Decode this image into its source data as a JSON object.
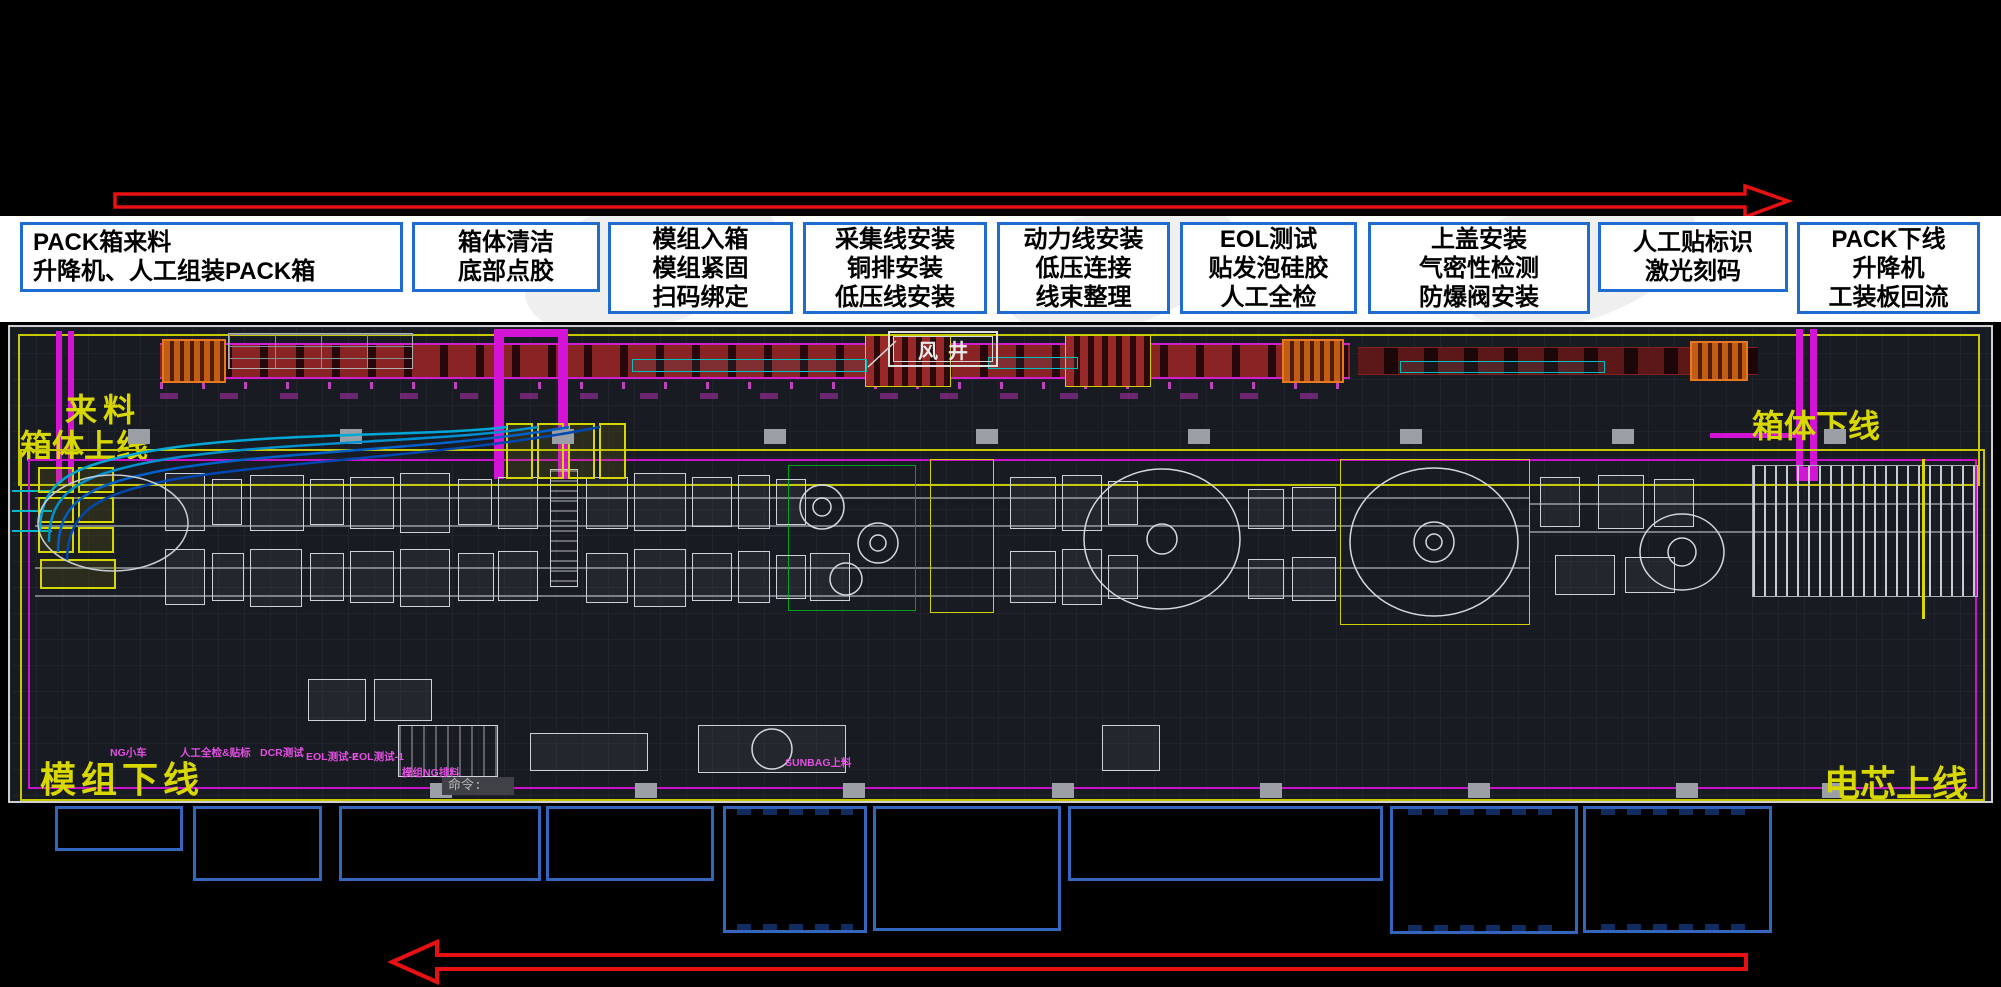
{
  "flow": {
    "top_arrow_direction": "right",
    "bottom_arrow_direction": "left",
    "arrow_color": "#e81111"
  },
  "process_steps": [
    {
      "line1": "PACK箱来料",
      "line2": "升降机、人工组装PACK箱",
      "line3": ""
    },
    {
      "line1": "箱体清洁",
      "line2": "底部点胶",
      "line3": ""
    },
    {
      "line1": "模组入箱",
      "line2": "模组紧固",
      "line3": "扫码绑定"
    },
    {
      "line1": "采集线安装",
      "line2": "铜排安装",
      "line3": "低压线安装"
    },
    {
      "line1": "动力线安装",
      "line2": "低压连接",
      "line3": "线束整理"
    },
    {
      "line1": "EOL测试",
      "line2": "贴发泡硅胶",
      "line3": "人工全检"
    },
    {
      "line1": "上盖安装",
      "line2": "气密性检测",
      "line3": "防爆阀安装"
    },
    {
      "line1": "人工贴标识",
      "line2": "激光刻码",
      "line3": ""
    },
    {
      "line1": "PACK下线",
      "line2": "升降机",
      "line3": "工装板回流"
    }
  ],
  "cad": {
    "labels": {
      "incoming": "来料",
      "box_line_in": "箱体上线",
      "box_line_out": "箱体下线",
      "wind_shaft": "风井",
      "module_offline": "模组下线",
      "cell_online": "电芯上线",
      "command_prompt": "命令:"
    },
    "machine_labels": [
      "NG小车",
      "人工全检&贴标",
      "DCR测试",
      "EOL测试-2",
      "EOL测试-1",
      "模组NG排料",
      "SUNBAG上料"
    ],
    "colors": {
      "background": "#191b22",
      "frame_yellow": "#c8c800",
      "frame_magenta": "#cc12cc",
      "label_yellow": "#d8d800",
      "machine_label_magenta": "#e24fe2",
      "step_box_border_blue": "#1e6bd2",
      "legend_box_border_blue": "#3566bd"
    }
  }
}
